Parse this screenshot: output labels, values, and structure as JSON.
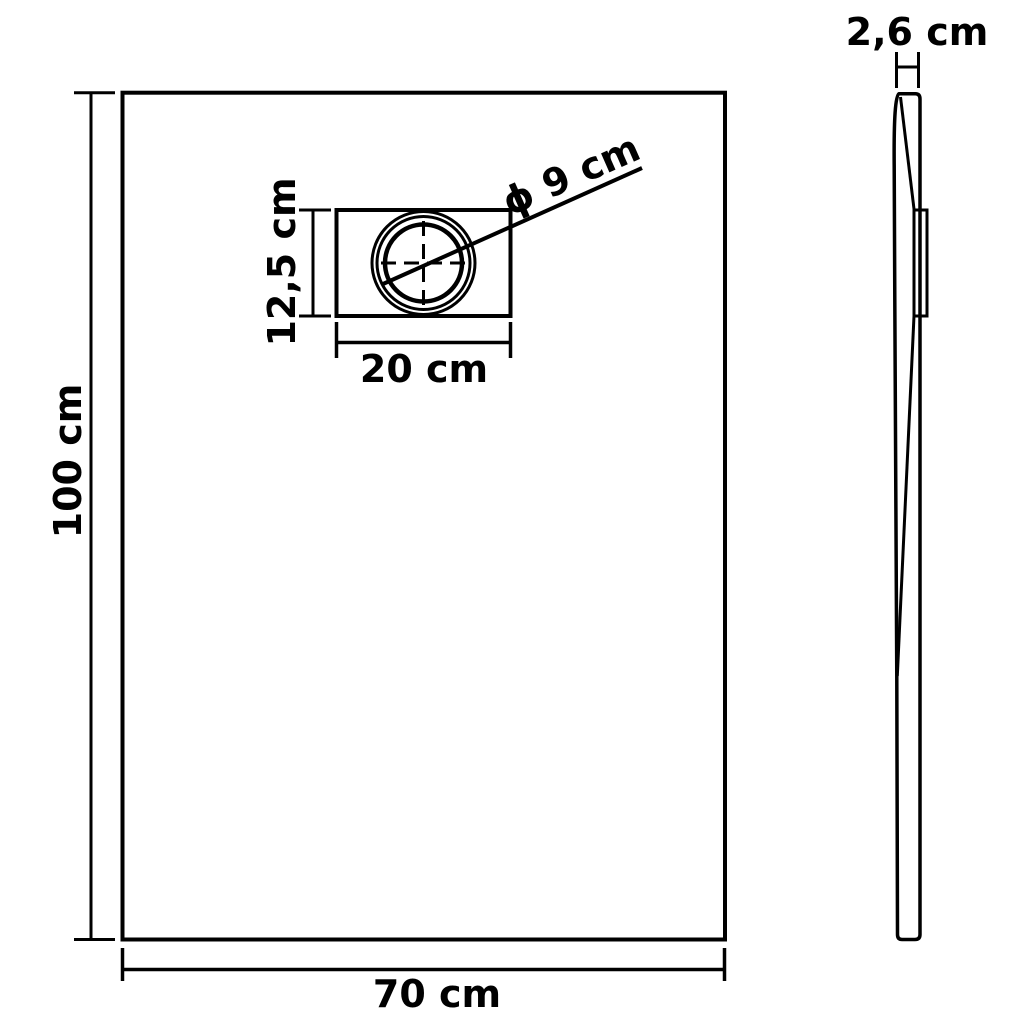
{
  "diagram": {
    "type": "product-dimension-drawing",
    "subject": "rectangular shower base tray with drain, front view and side profile view",
    "front_view": {
      "height_label": "100 cm",
      "width_label": "70 cm"
    },
    "drain_detail": {
      "box_height_label": "12,5 cm",
      "box_width_label": "20 cm",
      "diameter_label": "ϕ 9 cm"
    },
    "side_view": {
      "thickness_label": "2,6 cm"
    },
    "colors": {
      "line": "#000000",
      "background": "#ffffff"
    }
  }
}
